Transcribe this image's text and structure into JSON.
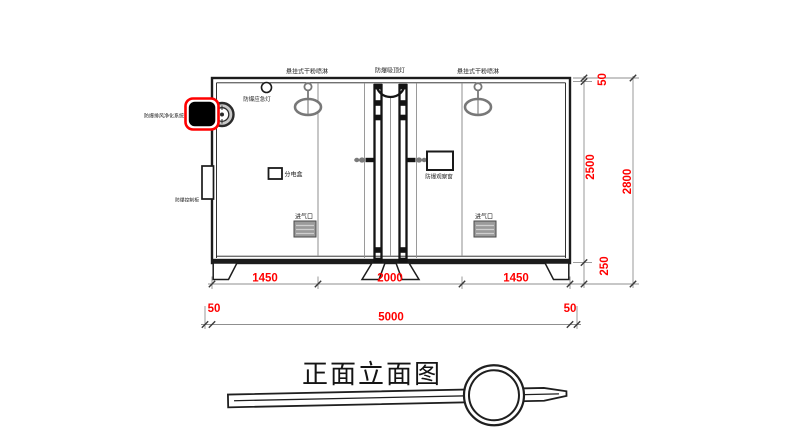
{
  "drawing": {
    "title": "正面立面图",
    "labels": {
      "hanging_sprinkler_left": "悬挂式干粉喷淋",
      "ceiling_lamp": "防爆吸顶灯",
      "hanging_sprinkler_right": "悬挂式干粉喷淋",
      "emergency_lamp": "防爆应急灯",
      "exhaust_purifier": "防爆排风净化系统",
      "control_cabinet": "防爆控制柜",
      "power_box": "分电盒",
      "observation_window": "防爆观察窗",
      "air_inlet_left": "进气口",
      "air_inlet_right": "进气口"
    },
    "dimensions": {
      "bay_left": "1450",
      "bay_center": "2000",
      "bay_right": "1450",
      "margin_left": "50",
      "total_width": "5000",
      "margin_right": "50",
      "top_offset": "50",
      "body_height": "2500",
      "base_height": "250",
      "total_height": "2800"
    },
    "colors": {
      "dimension_text": "#FF0000",
      "highlight": "#FF0000",
      "line": "#1C1C1C",
      "gray_part": "#7A7A7A"
    }
  }
}
